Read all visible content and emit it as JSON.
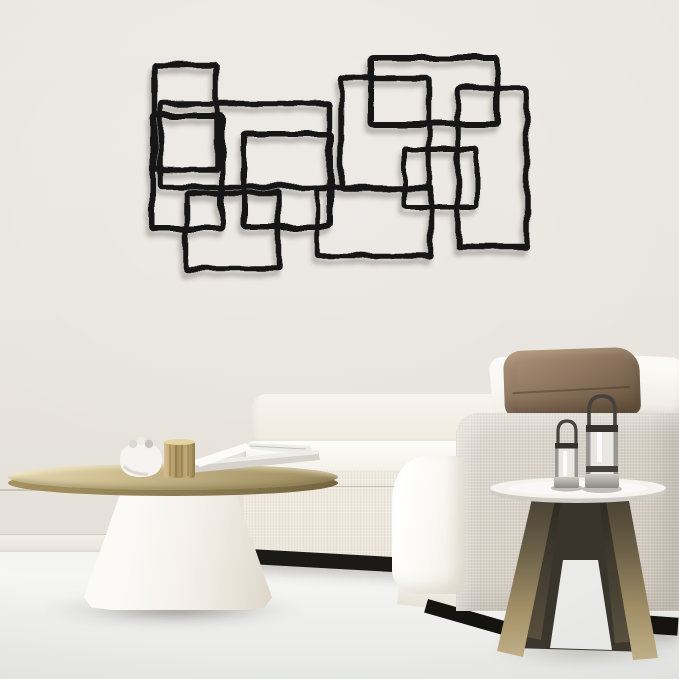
{
  "scene": {
    "description": "minimalist-living-room-product-photo",
    "objects": {
      "wall_art": "abstract-overlapping-rectangles-black-metal-wall-art",
      "sofa": "white-modular-linen-sofa-with-black-plinth",
      "pillows": [
        "white-throw-pillow",
        "brown-leather-pillow",
        "white-throw-pillow"
      ],
      "coffee_table": "round-brass-top-coffee-table-with-white-concrete-cone-base",
      "coffee_table_decor": [
        "white-round-bowl",
        "gold-textured-cup",
        "open-magazine-on-book"
      ],
      "side_table": "round-white-top-side-table-with-splayed-bronze-legs",
      "lanterns": [
        "small-metal-candle-lantern",
        "large-metal-candle-lantern"
      ]
    }
  },
  "palette": {
    "wall": "#e9e5e0",
    "floor": "#f0f1ef",
    "art": "#141312",
    "sofaWhite": "#faf8f4",
    "sofaCream": "#f2eee6",
    "sofaLinen": "#ece7dd",
    "armLinen": "#d5cfc6",
    "pillowBrown": "#8d7560",
    "plinth": "#18170f",
    "brassTop": "#b9a87c",
    "brassLight": "#ddd0a6",
    "brassDark": "#87774f",
    "coneWhite": "#f8f6f2",
    "sideTableTop": "#f4f3f0",
    "bronzeLeg": "#a3906a",
    "bronzeLegDark": "#3d382c",
    "lanternSilver": "#bdbab5",
    "lanternDark": "#35322e",
    "shadow": "#5f5a52"
  },
  "wall_art": {
    "stroke_color": "#141312",
    "rects": [
      {
        "x": 155,
        "y": 64,
        "w": 62,
        "h": 106,
        "sw": 5.5
      },
      {
        "x": 153,
        "y": 116,
        "w": 69,
        "h": 112,
        "sw": 6
      },
      {
        "x": 161,
        "y": 104,
        "w": 168,
        "h": 83,
        "sw": 5.5
      },
      {
        "x": 186,
        "y": 193,
        "w": 93,
        "h": 76,
        "sw": 5.5
      },
      {
        "x": 244,
        "y": 134,
        "w": 87,
        "h": 93,
        "sw": 6
      },
      {
        "x": 318,
        "y": 188,
        "w": 113,
        "h": 68,
        "sw": 5.5
      },
      {
        "x": 341,
        "y": 78,
        "w": 88,
        "h": 111,
        "sw": 5.5
      },
      {
        "x": 371,
        "y": 58,
        "w": 126,
        "h": 66,
        "sw": 6
      },
      {
        "x": 458,
        "y": 88,
        "w": 69,
        "h": 159,
        "sw": 5.5
      },
      {
        "x": 404,
        "y": 149,
        "w": 73,
        "h": 58,
        "sw": 5
      }
    ]
  }
}
